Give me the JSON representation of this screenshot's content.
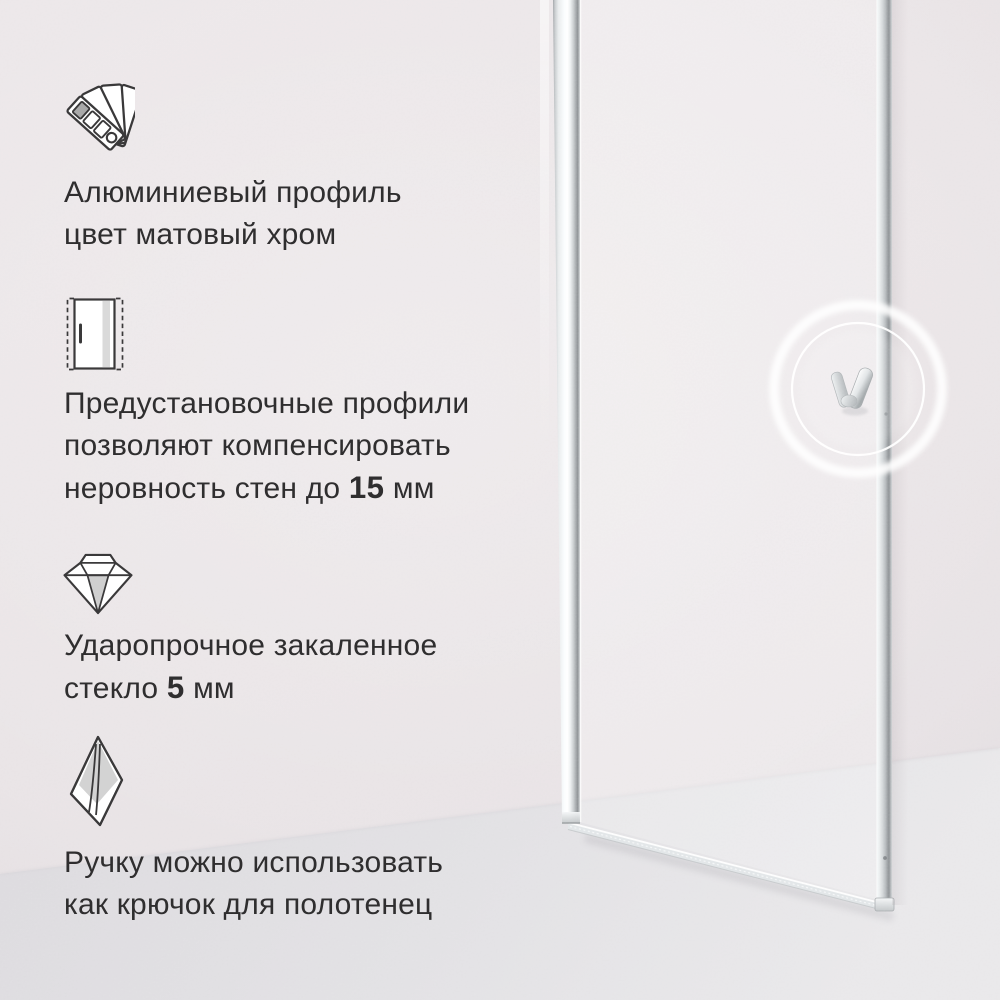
{
  "canvas": {
    "width": 1000,
    "height": 1000
  },
  "colors": {
    "wall": "#eae5e7",
    "floor-dark": "#dcdade",
    "floor-light": "#e9e8ea",
    "ink": "#2f2e2f",
    "icon-stroke": "#3a393a",
    "icon-gray": "#cfcfcf",
    "chrome-light": "#f7fafb",
    "chrome-dark": "#9ea2a5",
    "ring": "#ffffff"
  },
  "features": [
    {
      "icon": "color-swatches-icon",
      "lines": [
        [
          "Алюминиевый профиль"
        ],
        [
          "цвет матовый хром"
        ]
      ]
    },
    {
      "icon": "door-profile-icon",
      "lines": [
        [
          "Предустановочные профили"
        ],
        [
          "позволяют компенсировать"
        ],
        [
          "неровность стен до ",
          "15",
          " мм"
        ]
      ]
    },
    {
      "icon": "diamond-icon",
      "lines": [
        [
          "Ударопрочное закаленное"
        ],
        [
          "стекло ",
          "5",
          " мм"
        ]
      ]
    },
    {
      "icon": "towel-hook-icon",
      "lines": [
        [
          "Ручку можно использовать"
        ],
        [
          "как крючок для полотенец"
        ]
      ]
    }
  ]
}
